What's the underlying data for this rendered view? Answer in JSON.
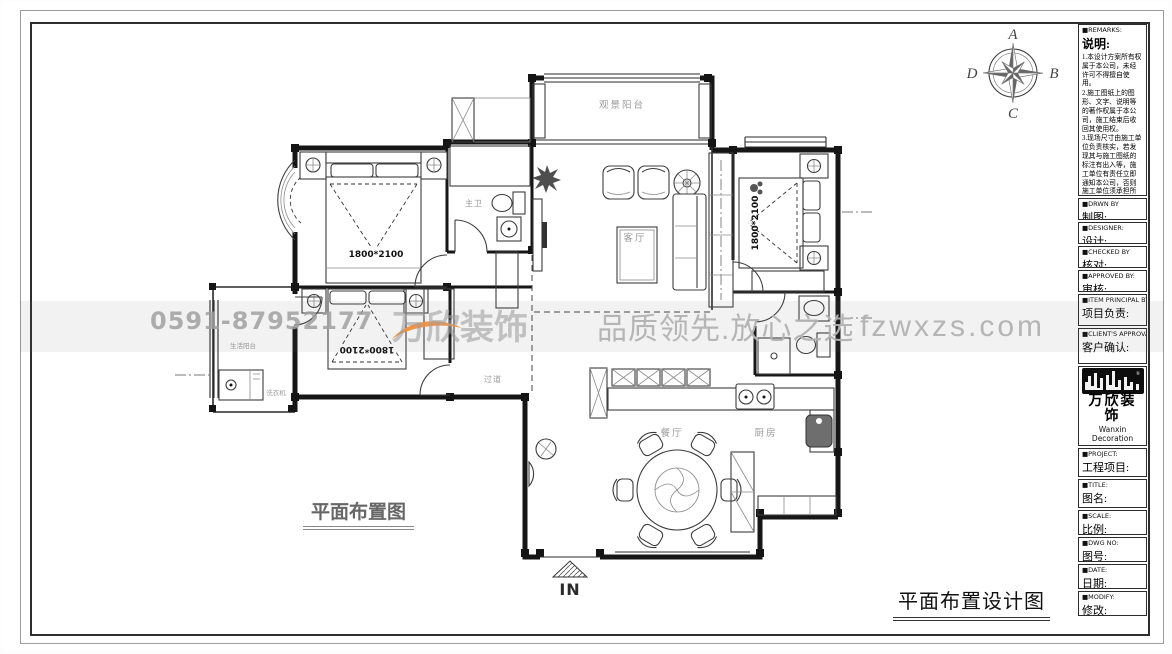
{
  "sheet": {
    "plan_label": "平面布置图",
    "sheet_title": "平面布置设计图"
  },
  "compass": {
    "n": "A",
    "e": "B",
    "s": "C",
    "w": "D"
  },
  "watermark": {
    "phone": "0591-87952177",
    "brand": "万欣装饰",
    "slogan": "品质领先.放心之选",
    "site": "fzwxzs.com",
    "orange": "#ef8f3e"
  },
  "floorplan": {
    "labels": {
      "balcony_top": "观景阳台",
      "living": "客厅",
      "master_bath": "主卫",
      "hallway": "过道",
      "dining": "餐厅",
      "kitchen": "厨房",
      "utility_balcony": "生活阳台",
      "washer": "洗衣机"
    },
    "bed_dim": "1800*2100",
    "entrance": "IN"
  },
  "titleblock": {
    "remarks_en": "■REMARKS:",
    "remarks_cn": "说明:",
    "notes": [
      "1.本设计方案所有权属于本公司，未经许可不得擅自使用。",
      "2.施工图纸上的图形、文字、说明等的著作权属于本公司，施工结束后收回其使用权。",
      "3.现场尺寸由施工单位负责核实，若发现其与施工图纸的标注有出入等，施工单位有责任立即通知本公司，否则施工单位须承担所有责任。",
      "4.本设计方案是按客户要求设计，经客户签字即视为同意认可，不得随意更改。"
    ],
    "fields": [
      {
        "en": "■DRWN BY",
        "cn": "制图:"
      },
      {
        "en": "■DESIGNER:",
        "cn": "设计:"
      },
      {
        "en": "■CHECKED BY",
        "cn": "核对:"
      },
      {
        "en": "■APPROVED BY:",
        "cn": "审核:"
      },
      {
        "en": "■ITEM PRINCIPAL BY:",
        "cn": "项目负责:"
      },
      {
        "en": "■CLIENT'S APPROVAL:",
        "cn": "客户确认:"
      }
    ],
    "company": {
      "name_cn": "万欣装饰",
      "name_en": "Wanxin Decoration",
      "reg": "®",
      "tel1": "Tel:(0591)87952-166",
      "tel2": "(0591)87952-177",
      "fax": "Fax:(0591)87952-199",
      "web": "Web:WWW.fzwxzs.com"
    },
    "fields2": [
      {
        "en": "■PROJECT:",
        "cn": "工程项目:"
      },
      {
        "en": "■TITLE:",
        "cn": "图名:"
      },
      {
        "en": "■SCALE:",
        "cn": "比例:"
      },
      {
        "en": "■DWG NO:",
        "cn": "图号:"
      },
      {
        "en": "■DATE:",
        "cn": "日期:"
      },
      {
        "en": "■MODIFY:",
        "cn": "修改:"
      }
    ]
  }
}
